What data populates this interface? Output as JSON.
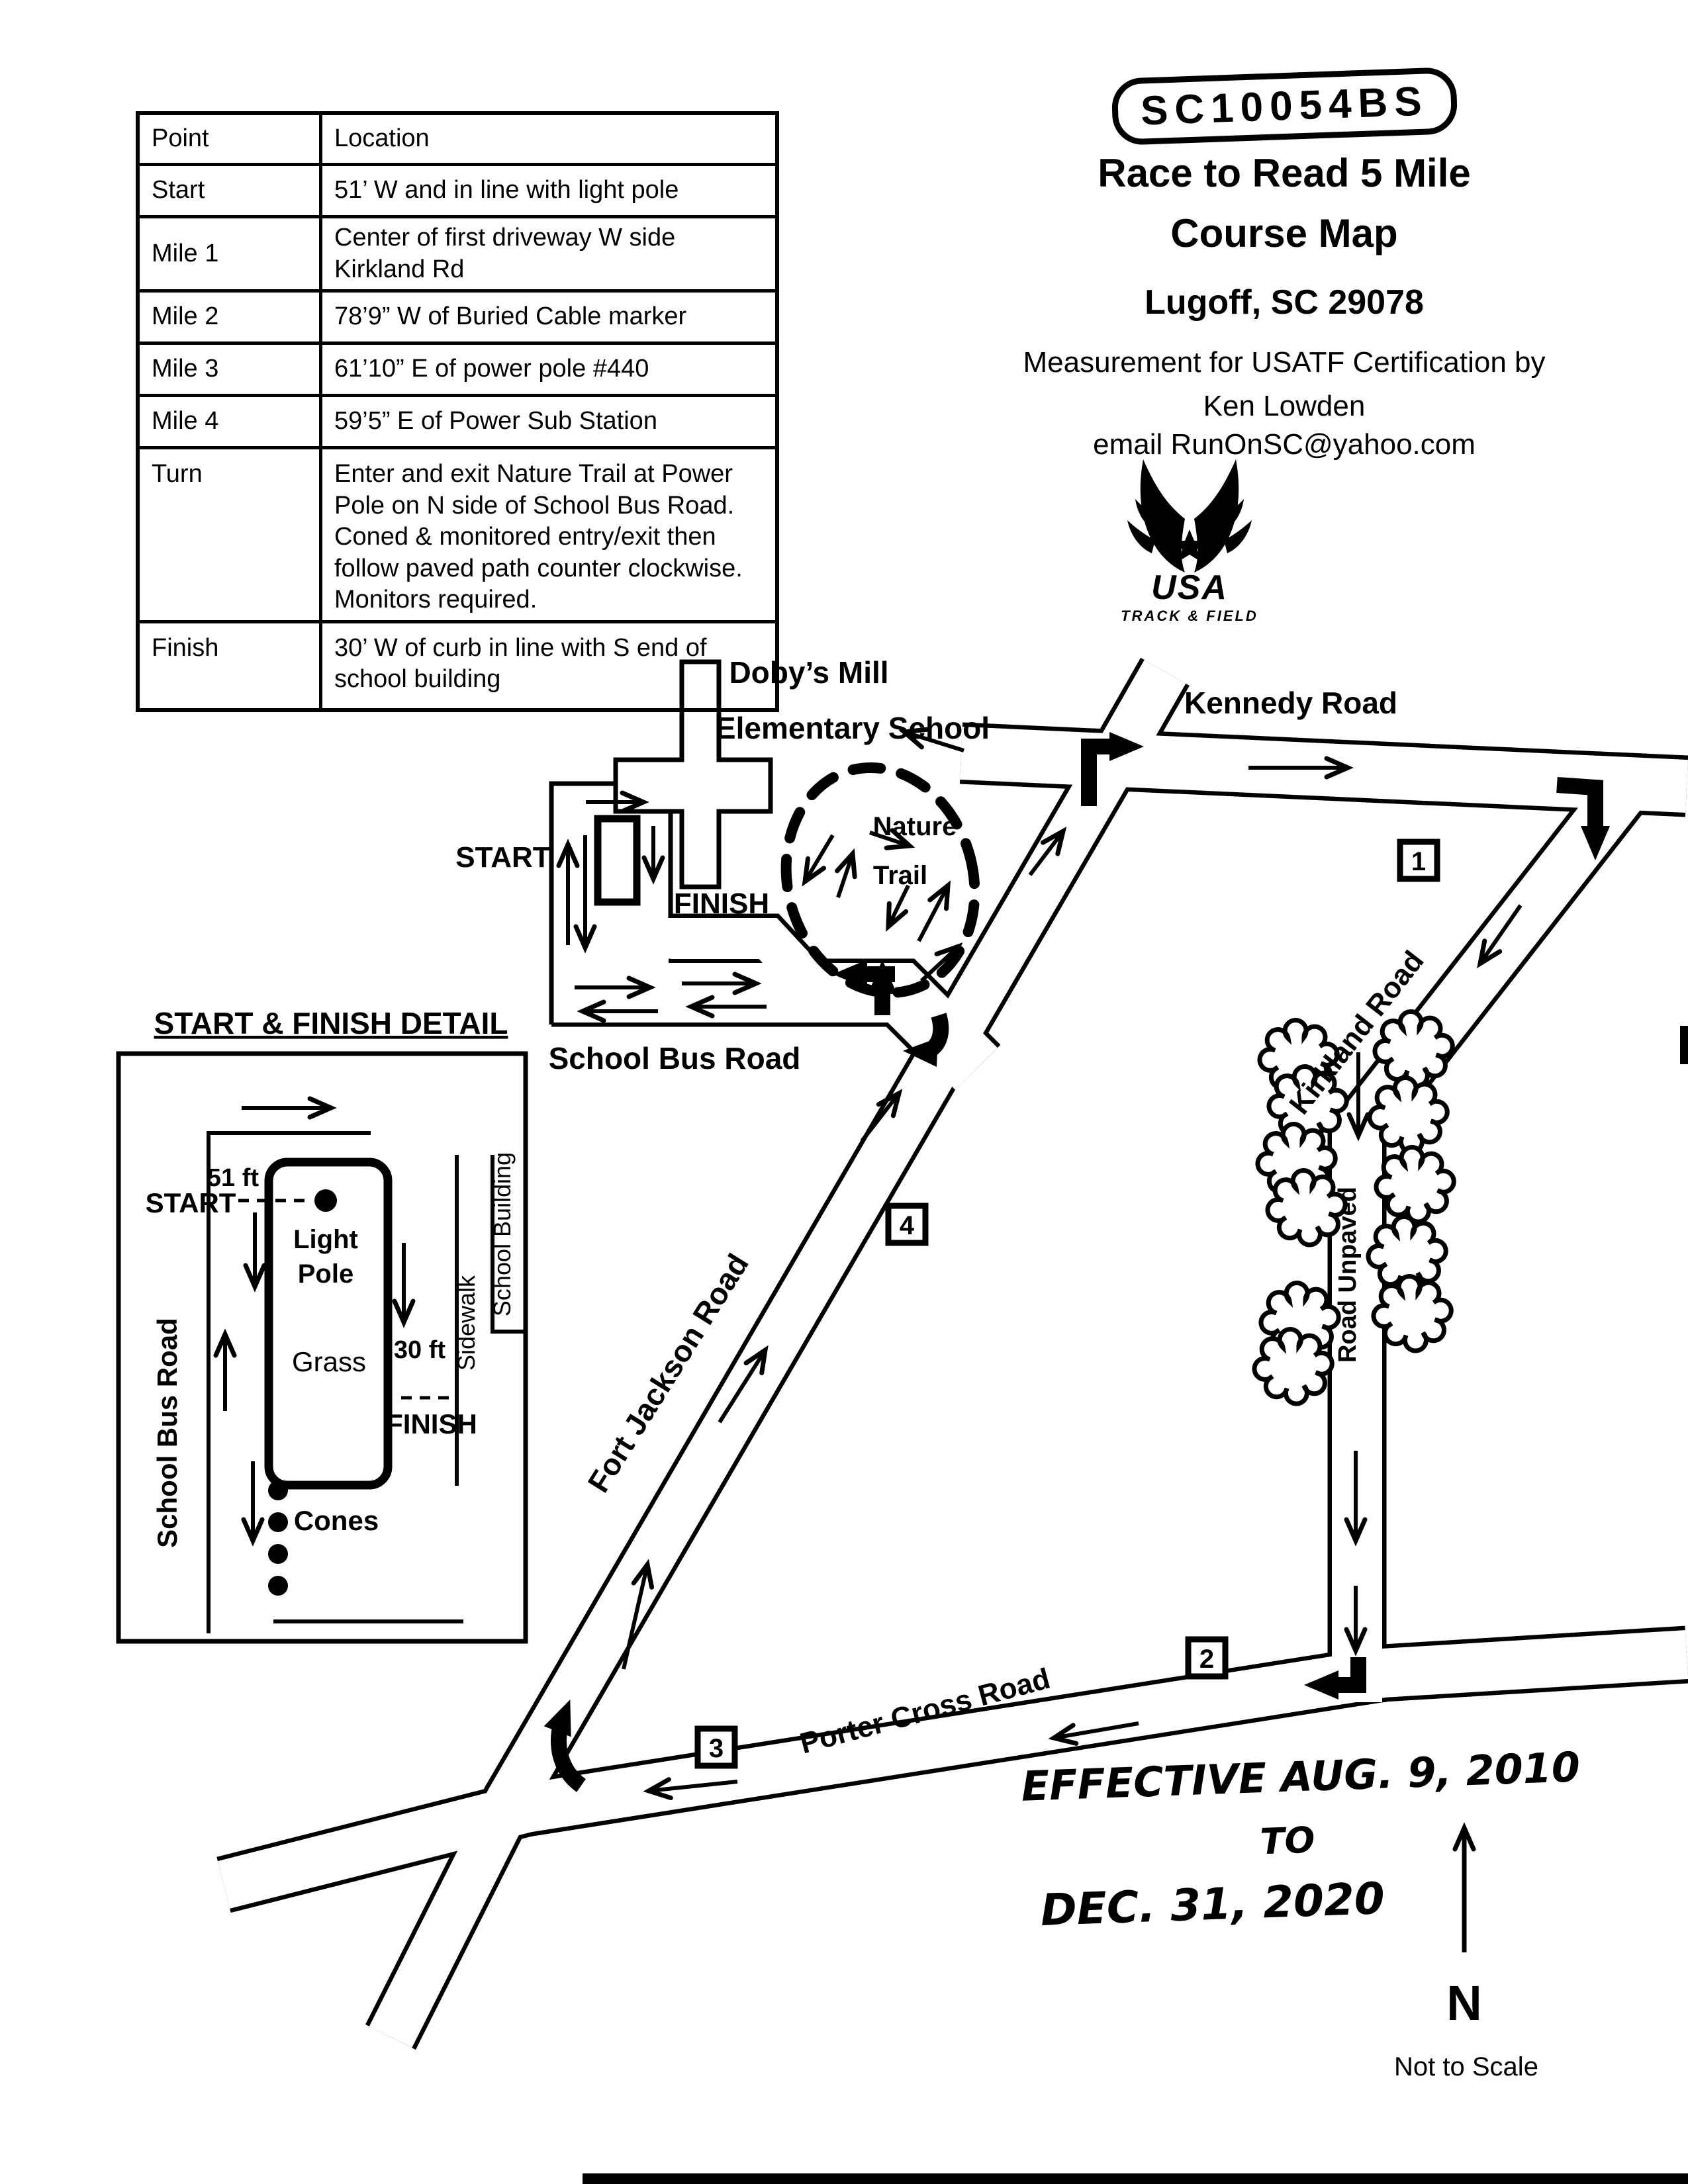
{
  "header": {
    "cert_id": "SC10054BS",
    "title_line1": "Race to Read 5 Mile",
    "title_line2": "Course Map",
    "location": "Lugoff, SC 29078",
    "measurement_line": "Measurement for USATF Certification by",
    "measurer": "Ken Lowden",
    "email_line": "email RunOnSC@yahoo.com"
  },
  "usatf_logo": {
    "org": "USA",
    "suborg": "TRACK & FIELD"
  },
  "table": {
    "headers": {
      "point": "Point",
      "location": "Location"
    },
    "rows": [
      {
        "point": "Start",
        "location": "51’ W and in line with light  pole"
      },
      {
        "point": "Mile 1",
        "location": "Center of first driveway W side Kirkland Rd"
      },
      {
        "point": "Mile 2",
        "location": "78’9” W of Buried Cable marker"
      },
      {
        "point": "Mile 3",
        "location": "61’10” E of power pole #440"
      },
      {
        "point": "Mile 4",
        "location": "59’5” E of Power Sub Station"
      },
      {
        "point": "Turn",
        "location": "Enter and exit Nature Trail at Power Pole on N side of School Bus Road. Coned & monitored entry/exit then follow paved path counter clockwise. Monitors required."
      },
      {
        "point": "Finish",
        "location": "30’ W of curb in line with S end of school building"
      }
    ]
  },
  "map": {
    "roads": {
      "kennedy": "Kennedy Road",
      "kirkland": "Kirkland Road",
      "unpaved": "Road Unpaved",
      "porter": "Porter Cross Road",
      "fort_jackson": "Fort Jackson Road",
      "school_bus": "School Bus Road"
    },
    "school_name_line1": "Doby’s Mill",
    "school_name_line2": "Elementary School",
    "nature_trail_line1": "Nature",
    "nature_trail_line2": "Trail",
    "start_label": "START",
    "finish_label": "FINISH",
    "mile_markers": [
      {
        "label": "1"
      },
      {
        "label": "2"
      },
      {
        "label": "3"
      },
      {
        "label": "4"
      }
    ]
  },
  "detail_inset": {
    "title": "START &  FINISH DETAIL",
    "school_bus_road": "School Bus Road",
    "dist_start": "51 ft",
    "start_label": "START",
    "light_pole_line1": "Light",
    "light_pole_line2": "Pole",
    "grass": "Grass",
    "dist_finish": "30 ft",
    "finish_label": "FINISH",
    "sidewalk": "Sidewalk",
    "school_building": "School Building",
    "cones": "Cones"
  },
  "footer": {
    "effective_line1": "EFFECTIVE AUG. 9, 2010",
    "effective_line2": "TO",
    "effective_line3": "DEC. 31, 2020",
    "north": "N",
    "scale_note": "Not to Scale"
  }
}
